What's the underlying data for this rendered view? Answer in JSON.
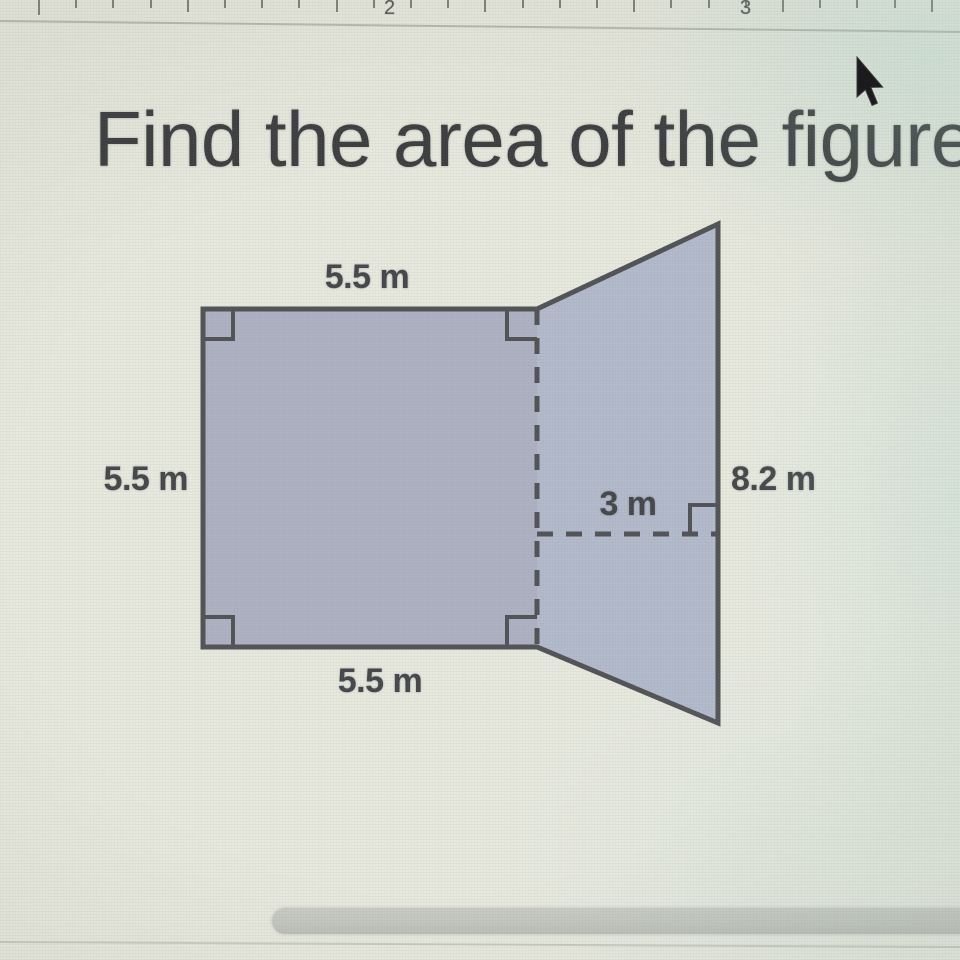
{
  "window": {
    "ruler": {
      "unit_labels": [
        {
          "text": "2",
          "x": 384
        },
        {
          "text": "3",
          "x": 740
        }
      ],
      "ticks": {
        "start_x": 38,
        "spacing": 37.2,
        "count": 25
      }
    }
  },
  "problem": {
    "title": "Find the area of the figure"
  },
  "figure": {
    "type": "composite-shape",
    "description": "square joined to a right trapezoid along a dashed vertical line",
    "dimensions": {
      "top": "5.5 m",
      "left": "5.5 m",
      "bottom": "5.5 m",
      "right": "8.2 m",
      "trapezoid_height": "3 m"
    },
    "colors": {
      "square_fill": "#aeb1c2",
      "trapezoid_fill": "#b2bacc",
      "outline": "#525356",
      "label_text": "#46474b"
    }
  }
}
